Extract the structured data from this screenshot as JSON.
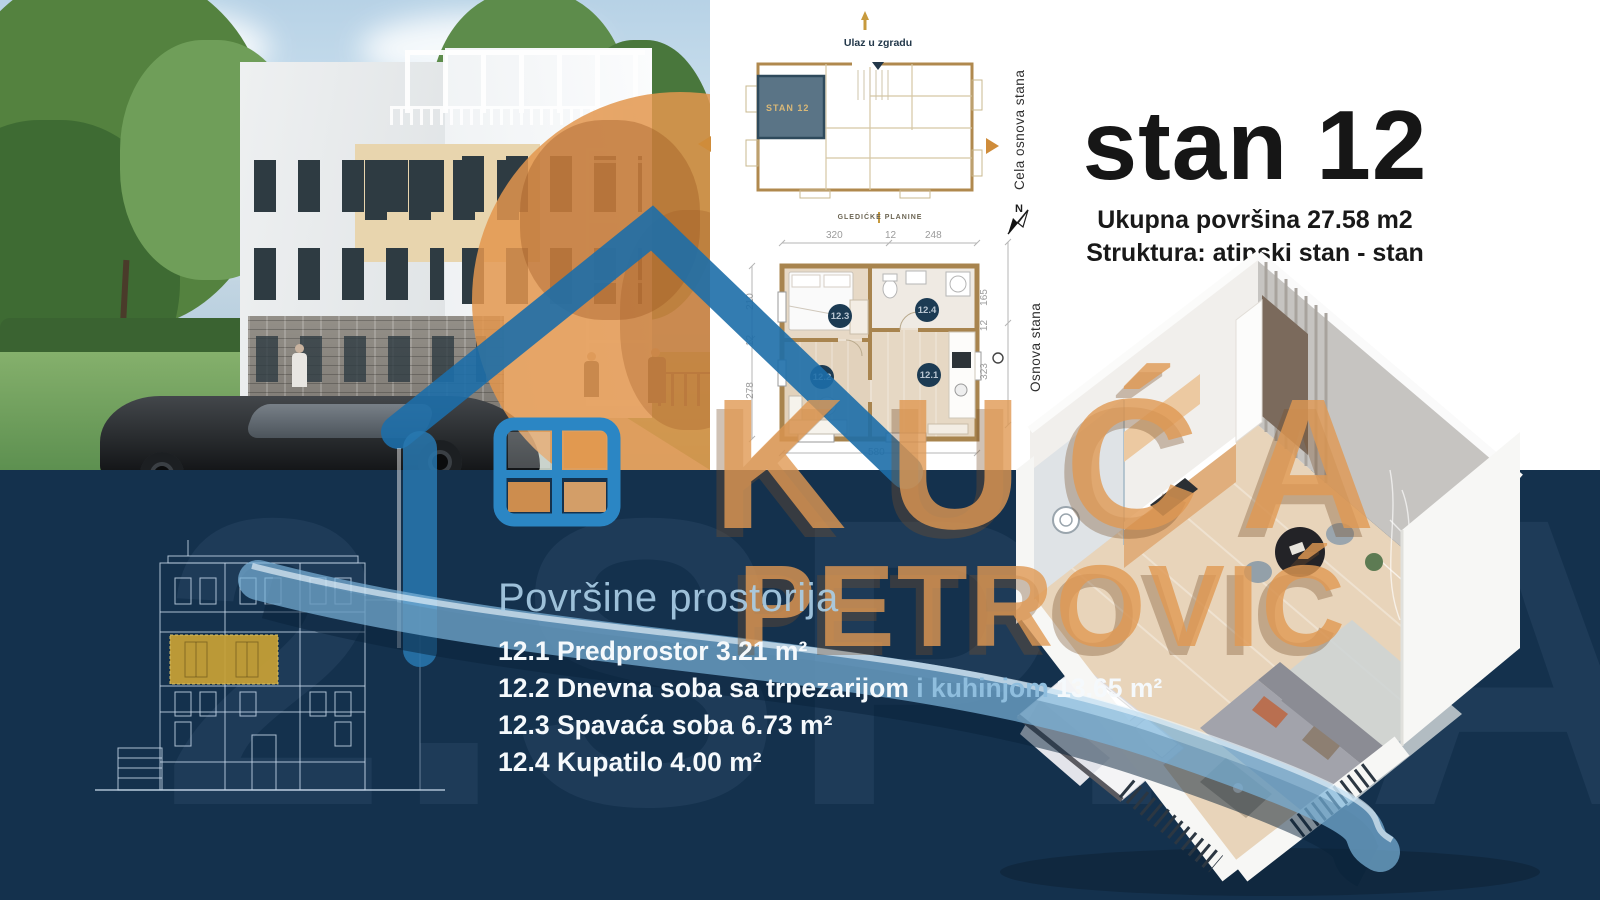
{
  "brand": {
    "word1": "KUĆA",
    "word2": "PETROVIĆ"
  },
  "background_watermark": "2.SPRAT",
  "title_block": {
    "title": "stan 12",
    "area_line": "Ukupna površina 27.58 m2",
    "structure_line": "Struktura: atipski stan - stan"
  },
  "full_plan": {
    "label": "Cela osnova stana",
    "entrance_label": "Ulaz u zgradu",
    "unit_highlight_label": "STAN 12",
    "north_label": "N"
  },
  "unit_plan": {
    "label": "Osnova stana",
    "project_logo": "GLEDIĆKE PLANINE",
    "dims_top": [
      "320",
      "12",
      "248"
    ],
    "dims_left": [
      "210",
      "12",
      "278"
    ],
    "dims_right": [
      "165",
      "12",
      "323"
    ],
    "dim_bottom": "580",
    "markers": {
      "hall": "12.1",
      "living": "12.2",
      "bedroom": "12.3",
      "bath": "12.4"
    }
  },
  "rooms_panel": {
    "heading": "Površine prostorija",
    "items": [
      {
        "pre": "12.1 Predprostor 3.21 m²"
      },
      {
        "pre": "12.2 Dnevna soba sa trpezarijom ",
        "accent": "i kuhinjom",
        "post": " 13.65 m²"
      },
      {
        "pre": "12.3 Spavaća soba 6.73 m²"
      },
      {
        "pre": "12.4 Kupatilo 4.00 m²"
      }
    ]
  },
  "colors": {
    "navy_bg": "#14314D",
    "accent_orange": "#E09A56",
    "logo_blue": "#1E6FA8",
    "ribbon_blue": "#78B4DC",
    "highlight_gold": "#C8A136",
    "plan_unit_slate": "#5A7486"
  }
}
